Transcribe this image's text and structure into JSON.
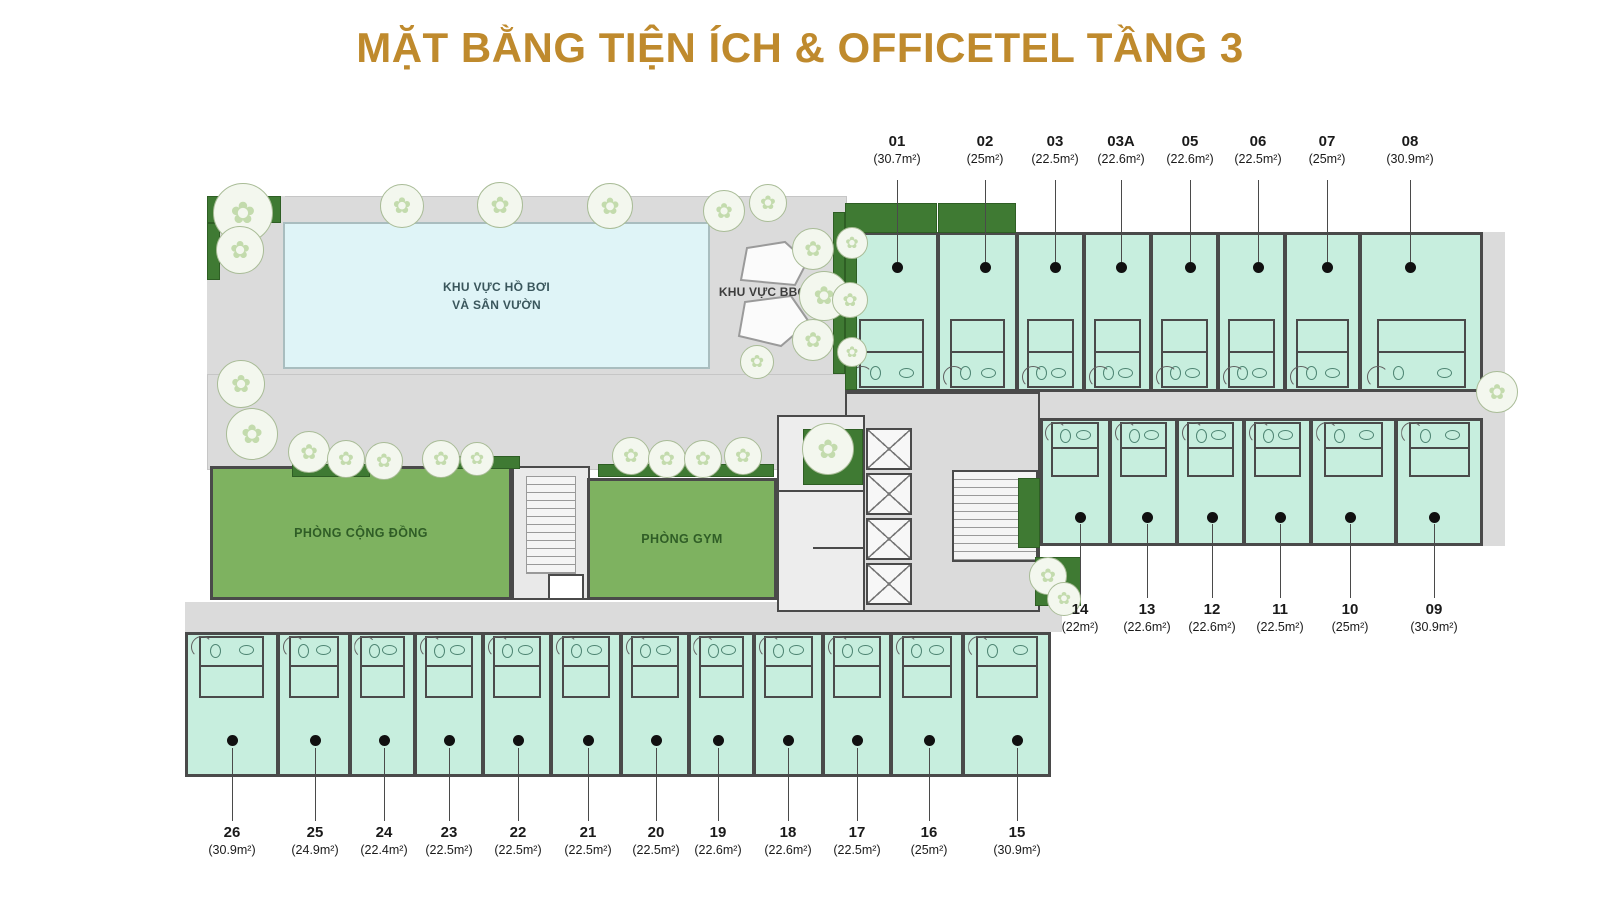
{
  "title": "MẶT BẰNG TIỆN ÍCH & OFFICETEL TẦNG 3",
  "colors": {
    "title_gold": "#BF8A2D",
    "wall": "#4A4A4A",
    "unit_fill": "#C7EEDE",
    "deck_gray": "#DBDBDB",
    "pool_blue": "#DFF4F7",
    "room_green": "#7EB260",
    "planter_green": "#3F7A33",
    "label_text": "#1A1A1A",
    "room_label_green": "#2F5D26",
    "pool_label": "#3A565C",
    "dot_black": "#101010"
  },
  "areas": {
    "pool_line1": "KHU VỰC HỒ BƠI",
    "pool_line2": "VÀ SÂN VƯỜN",
    "bbq": "KHU VỰC BBQ",
    "community": "PHÒNG CỘNG ĐỒNG",
    "gym": "PHÒNG GYM"
  },
  "rows": [
    {
      "name": "top",
      "unit_y": 232,
      "unit_h": 160,
      "bath": "bottom",
      "dot_y": 267,
      "line_y1": 180,
      "line_y2": 262,
      "label_y": 133,
      "units": [
        {
          "id": "01",
          "area": "(30.7m²)",
          "x": 845,
          "w": 93,
          "cx": 897
        },
        {
          "id": "02",
          "area": "(25m²)",
          "x": 938,
          "w": 79,
          "cx": 985
        },
        {
          "id": "03",
          "area": "(22.5m²)",
          "x": 1017,
          "w": 67,
          "cx": 1055
        },
        {
          "id": "03A",
          "area": "(22.6m²)",
          "x": 1084,
          "w": 67,
          "cx": 1121
        },
        {
          "id": "05",
          "area": "(22.6m²)",
          "x": 1151,
          "w": 67,
          "cx": 1190
        },
        {
          "id": "06",
          "area": "(22.5m²)",
          "x": 1218,
          "w": 67,
          "cx": 1258
        },
        {
          "id": "07",
          "area": "(25m²)",
          "x": 1285,
          "w": 75,
          "cx": 1327
        },
        {
          "id": "08",
          "area": "(30.9m²)",
          "x": 1360,
          "w": 123,
          "cx": 1410
        }
      ]
    },
    {
      "name": "middle",
      "unit_y": 418,
      "unit_h": 128,
      "bath": "top",
      "dot_y": 517,
      "line_y1": 524,
      "line_y2": 598,
      "label_y": 601,
      "units": [
        {
          "id": "14",
          "area": "(22m²)",
          "x": 1040,
          "w": 70,
          "cx": 1080
        },
        {
          "id": "13",
          "area": "(22.6m²)",
          "x": 1110,
          "w": 67,
          "cx": 1147
        },
        {
          "id": "12",
          "area": "(22.6m²)",
          "x": 1177,
          "w": 67,
          "cx": 1212
        },
        {
          "id": "11",
          "area": "(22.5m²)",
          "x": 1244,
          "w": 67,
          "cx": 1280
        },
        {
          "id": "10",
          "area": "(25m²)",
          "x": 1311,
          "w": 85,
          "cx": 1350
        },
        {
          "id": "09",
          "area": "(30.9m²)",
          "x": 1396,
          "w": 87,
          "cx": 1434
        }
      ]
    },
    {
      "name": "bottom",
      "unit_y": 632,
      "unit_h": 145,
      "bath": "top",
      "dot_y": 740,
      "line_y1": 748,
      "line_y2": 821,
      "label_y": 824,
      "units": [
        {
          "id": "26",
          "area": "(30.9m²)",
          "x": 185,
          "w": 93,
          "cx": 232
        },
        {
          "id": "25",
          "area": "(24.9m²)",
          "x": 278,
          "w": 72,
          "cx": 315
        },
        {
          "id": "24",
          "area": "(22.4m²)",
          "x": 350,
          "w": 65,
          "cx": 384
        },
        {
          "id": "23",
          "area": "(22.5m²)",
          "x": 415,
          "w": 68,
          "cx": 449
        },
        {
          "id": "22",
          "area": "(22.5m²)",
          "x": 483,
          "w": 68,
          "cx": 518
        },
        {
          "id": "21",
          "area": "(22.5m²)",
          "x": 551,
          "w": 70,
          "cx": 588
        },
        {
          "id": "20",
          "area": "(22.5m²)",
          "x": 621,
          "w": 68,
          "cx": 656
        },
        {
          "id": "19",
          "area": "(22.6m²)",
          "x": 689,
          "w": 65,
          "cx": 718
        },
        {
          "id": "18",
          "area": "(22.6m²)",
          "x": 754,
          "w": 69,
          "cx": 788
        },
        {
          "id": "17",
          "area": "(22.5m²)",
          "x": 823,
          "w": 68,
          "cx": 857
        },
        {
          "id": "16",
          "area": "(25m²)",
          "x": 891,
          "w": 72,
          "cx": 929
        },
        {
          "id": "15",
          "area": "(30.9m²)",
          "x": 963,
          "w": 88,
          "cx": 1017
        }
      ]
    }
  ],
  "row_outlines": [
    {
      "x": 845,
      "y": 232,
      "w": 638,
      "h": 160
    },
    {
      "x": 1040,
      "y": 418,
      "w": 443,
      "h": 128
    },
    {
      "x": 185,
      "y": 632,
      "w": 866,
      "h": 145
    }
  ],
  "planters": [
    [
      845,
      203,
      92,
      30
    ],
    [
      938,
      203,
      78,
      30
    ],
    [
      207,
      196,
      74,
      27
    ],
    [
      207,
      223,
      13,
      57
    ],
    [
      833,
      212,
      12,
      162
    ],
    [
      845,
      237,
      12,
      153
    ],
    [
      803,
      429,
      60,
      56
    ],
    [
      292,
      464,
      78,
      13
    ],
    [
      428,
      456,
      92,
      13
    ],
    [
      598,
      464,
      176,
      13
    ],
    [
      1018,
      478,
      22,
      70
    ],
    [
      1035,
      557,
      46,
      49
    ]
  ],
  "trees": [
    [
      243,
      213,
      30
    ],
    [
      240,
      250,
      24
    ],
    [
      402,
      206,
      22
    ],
    [
      500,
      205,
      23
    ],
    [
      610,
      206,
      23
    ],
    [
      724,
      211,
      21
    ],
    [
      768,
      203,
      19
    ],
    [
      813,
      249,
      21
    ],
    [
      824,
      296,
      25
    ],
    [
      813,
      340,
      21
    ],
    [
      757,
      362,
      17
    ],
    [
      852,
      243,
      16
    ],
    [
      850,
      300,
      18
    ],
    [
      852,
      352,
      15
    ],
    [
      241,
      384,
      24
    ],
    [
      252,
      434,
      26
    ],
    [
      309,
      452,
      21
    ],
    [
      346,
      459,
      19
    ],
    [
      384,
      461,
      19
    ],
    [
      441,
      459,
      19
    ],
    [
      477,
      459,
      17
    ],
    [
      631,
      456,
      19
    ],
    [
      667,
      459,
      19
    ],
    [
      703,
      459,
      19
    ],
    [
      743,
      456,
      19
    ],
    [
      828,
      449,
      26
    ],
    [
      1497,
      392,
      21
    ],
    [
      1048,
      576,
      19
    ],
    [
      1064,
      599,
      17
    ]
  ],
  "lifts": {
    "x": 866,
    "y_start": 428,
    "cell_h": 45,
    "count": 4
  }
}
